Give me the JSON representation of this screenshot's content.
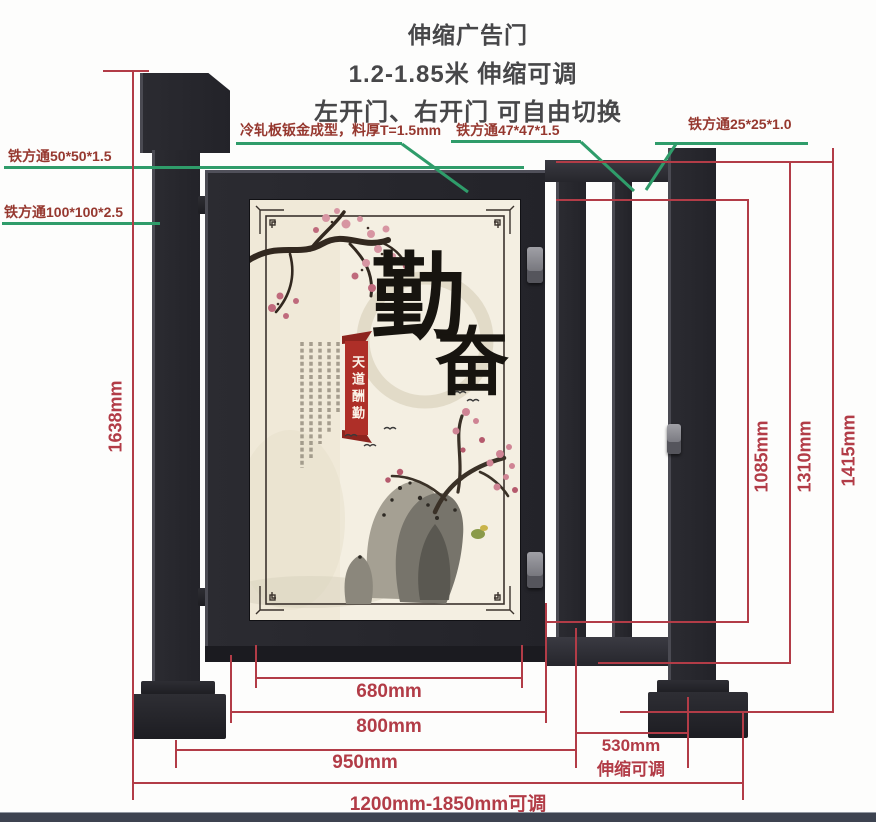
{
  "title": {
    "product": "伸缩广告门",
    "range": "1.2-1.85米 伸缩可调",
    "switch": "左开门、右开门 可自由切换"
  },
  "callouts": {
    "sheet_metal": "冷轧板钣金成型，料厚T=1.5mm",
    "tube47": "铁方通47*47*1.5",
    "tube25": "铁方通25*25*1.0",
    "tube50": "铁方通50*50*1.5",
    "tube100": "铁方通100*100*2.5"
  },
  "dimensions": {
    "total_height": "1638mm",
    "rail_height": "1085mm",
    "door_height": "1310mm",
    "post_height": "1415mm",
    "poster_width": "680mm",
    "door_width": "800mm",
    "fixed_span": "950mm",
    "retract_span": "530mm",
    "retract_note": "伸缩可调",
    "overall_range": "1200mm-1850mm可调"
  },
  "poster": {
    "calligraphy_char1": "勤",
    "calligraphy_char2": "奋",
    "banner": "天道酬勤"
  },
  "colors": {
    "dimension_red": "#b23c47",
    "callout_green": "#2f9c6a",
    "callout_text": "#96382f",
    "metal_dark": "#2b2b31",
    "poster_bg": "#f4efe2",
    "banner_red": "#ae2f28",
    "footer_bar": "#3d4350"
  }
}
